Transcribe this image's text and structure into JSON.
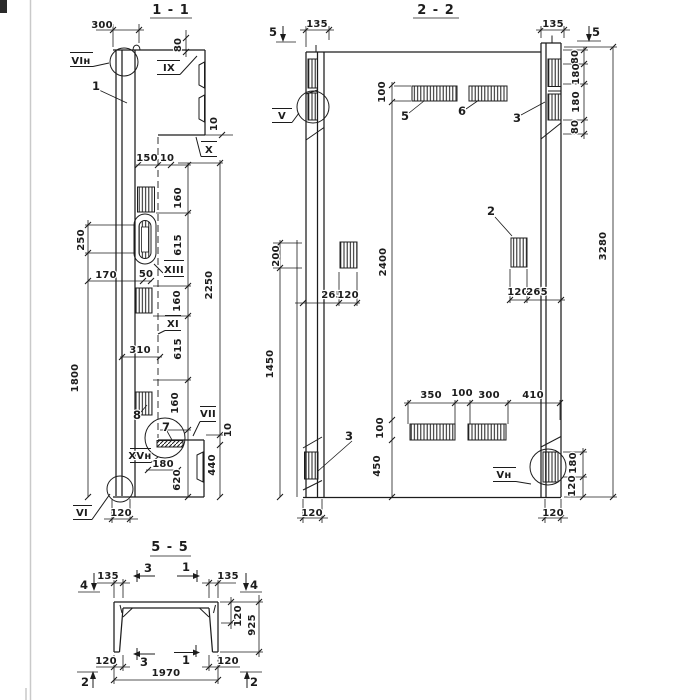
{
  "s1": {
    "title": "1 - 1",
    "nodes": {
      "vi_top": "VIн",
      "ix": "IX",
      "x": "X",
      "xiii": "XIII",
      "xi": "XI",
      "vii": "VII",
      "xv": "XVн",
      "vi_bot": "VI"
    },
    "parts": {
      "p1": "1",
      "p7": "7",
      "p8": "8"
    },
    "dims": {
      "w300": "300",
      "h80": "80",
      "t10a": "10",
      "w150": "150",
      "t10b": "10",
      "h160a": "160",
      "h615a": "615",
      "h160b": "160",
      "h615b": "615",
      "h160c": "160",
      "h2250": "2250",
      "h440": "440",
      "t10c": "10",
      "h250": "250",
      "h1800": "1800",
      "w170": "170",
      "w50": "50",
      "w310": "310",
      "w180": "180",
      "h620": "620",
      "w120": "120"
    }
  },
  "s2": {
    "title": "2 - 2",
    "nodes": {
      "v": "V",
      "v_n": "Vн"
    },
    "parts": {
      "p2": "2",
      "p3a": "3",
      "p3b": "3",
      "p5": "5",
      "p6": "6"
    },
    "marks": {
      "m5a": "5",
      "m5b": "5"
    },
    "dims": {
      "w135a": "135",
      "w135b": "135",
      "h100a": "100",
      "h2400": "2400",
      "h100b": "100",
      "h450": "450",
      "h200": "200",
      "h1450": "1450",
      "w265a": "265",
      "w120a": "120",
      "w120b": "120",
      "w265b": "265",
      "h80a": "80",
      "h180a": "180",
      "h180b": "180",
      "h80b": "80",
      "h3280": "3280",
      "w350": "350",
      "w100": "100",
      "w300": "300",
      "w410": "410",
      "h180c": "180",
      "h120c": "120",
      "w120bl": "120",
      "w120br": "120"
    }
  },
  "s5": {
    "title": "5 - 5",
    "marks": {
      "m4a": "4",
      "m3a": "3",
      "m1a": "1",
      "m4b": "4",
      "m3b": "3",
      "m1b": "1",
      "m2a": "2",
      "m2b": "2"
    },
    "dims": {
      "w135a": "135",
      "w135b": "135",
      "h120": "120",
      "h925": "925",
      "w120a": "120",
      "w120b": "120",
      "w1970": "1970"
    }
  }
}
